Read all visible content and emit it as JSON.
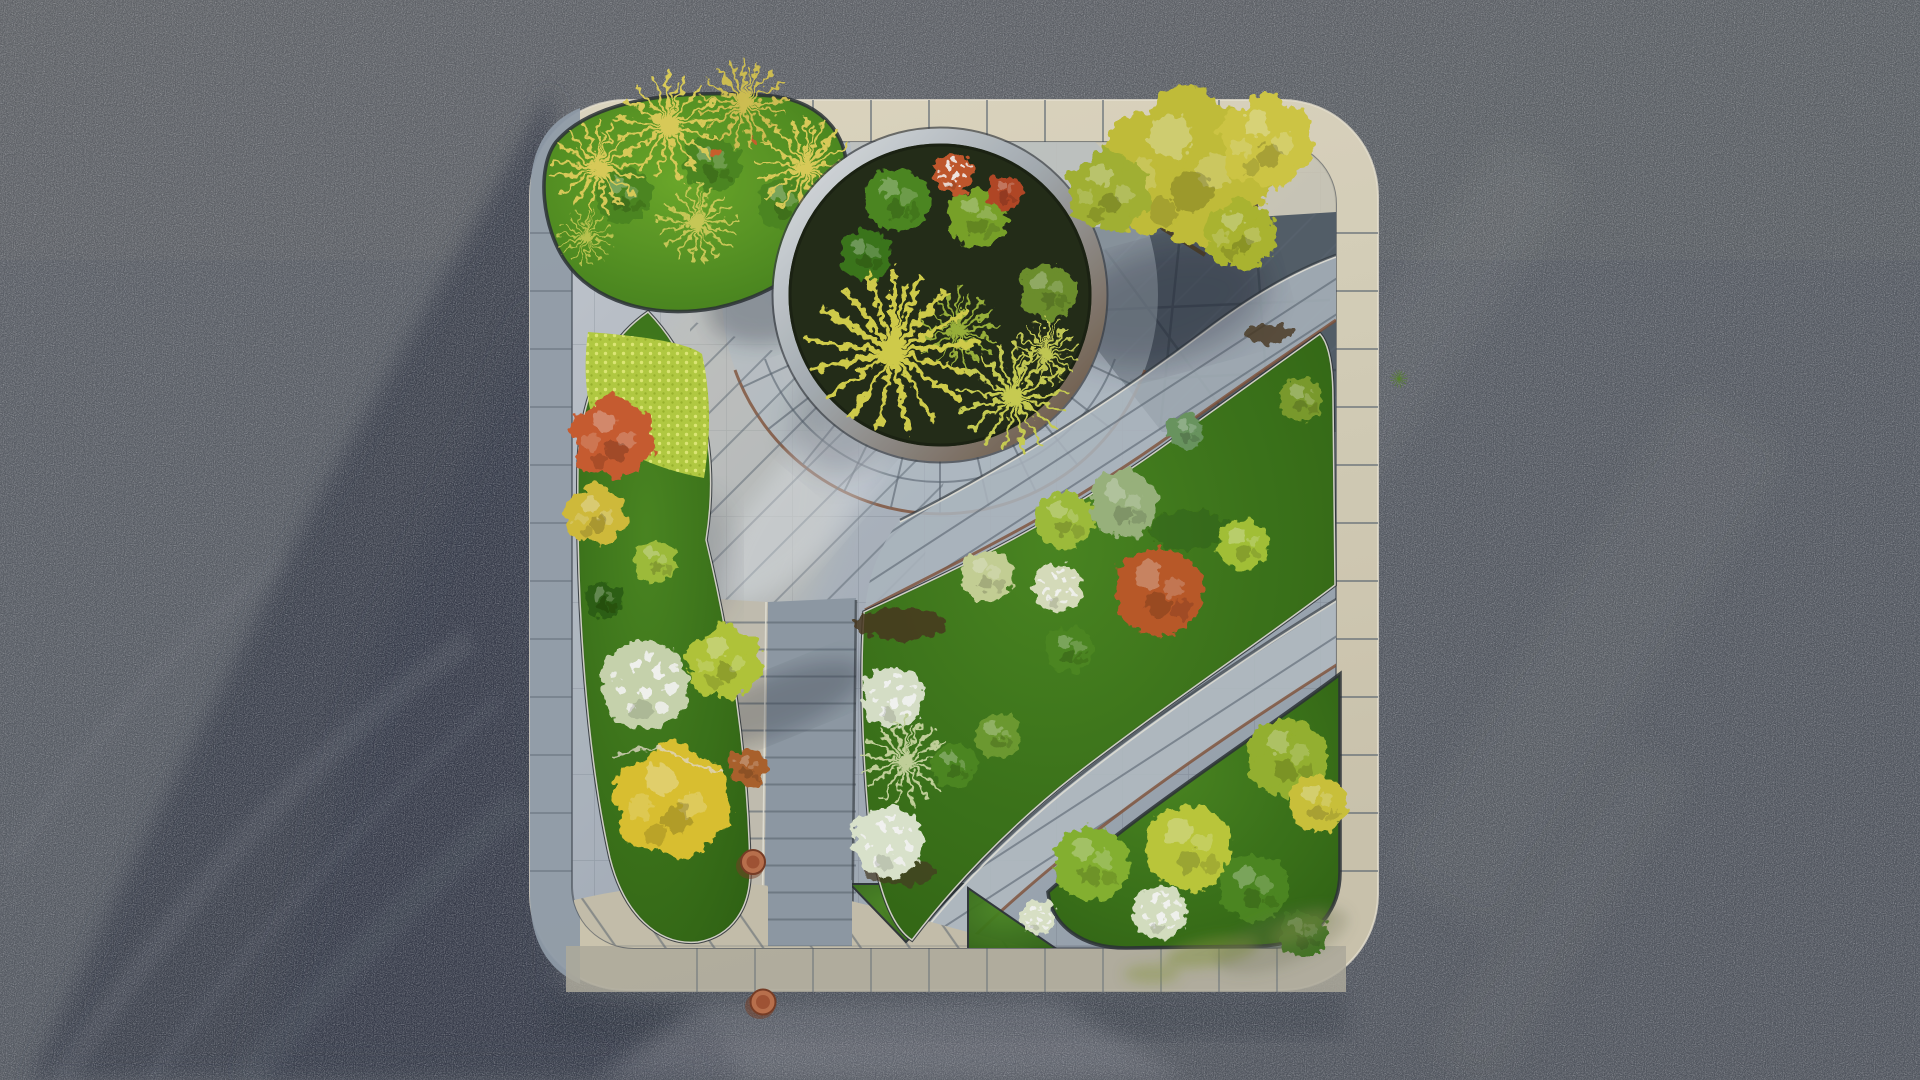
{
  "scene": {
    "title": "Aerial top-down view of a rounded-square landscaped garden plaza set in an asphalt lot, low sun casting a long diagonal shadow from the upper right",
    "setting": "dark speckled asphalt parking surface surrounding a square garden island with rounded corners and a pale stone curb",
    "lighting": "warm low-angle sunlight from the upper right; large soft building shadow covering the left asphalt; streaked tire marks in the shadow",
    "elements": [
      {
        "name": "asphalt-lot",
        "description": "dark blue-grey asphalt with fine stone speckle texture",
        "position": "entire background"
      },
      {
        "name": "building-shadow",
        "description": "long diagonal soft shadow wedge across the asphalt",
        "position": "left half, widening toward bottom-left"
      },
      {
        "name": "plaza",
        "description": "rounded-square garden plaza with pale limestone curb band",
        "position": "center-right of frame"
      },
      {
        "name": "circular-planter",
        "description": "round planter with silver-to-bronze steel rim holding yucca starbursts, ornamental grasses, green and orange shrubs over dark soil",
        "position": "upper middle of plaza"
      },
      {
        "name": "grass-mound",
        "description": "sunlit lawn mound with five golden tussock grasses spilling over the corner curb",
        "position": "top-left corner of plaza"
      },
      {
        "name": "canopy-tree",
        "description": "large yellow-green open-canopy tree shading dark slate paving",
        "position": "top-right of plaza"
      },
      {
        "name": "left-bed",
        "description": "crescent planting bed with chartreuse groundcover, orange-red tree, yellow trees, white flowering tree and a large golden tree at its foot",
        "position": "left side of plaza"
      },
      {
        "name": "central-bed",
        "description": "leaf-shaped lawn bed holding round shrubs: silver-sage, lime, pale yellow, white hydrangeas, large orange-red shrub, blue conifer and a silver spiky yucca, with dark mulch patches",
        "position": "center-right of plaza"
      },
      {
        "name": "corner-bed",
        "description": "lawn bed with lime, golden and white flowering shrubs and moss-stained curb",
        "position": "bottom-right corner of plaza"
      },
      {
        "name": "main-path",
        "description": "two-tone bluestone path with ladder joints, cream column on left and blue-grey column on right, running to the bottom edge",
        "position": "center, vertical"
      },
      {
        "name": "diagonal-path-upper",
        "description": "broad curved paved band with rung joints sweeping from the circle down-right to the east curb",
        "position": "upper right"
      },
      {
        "name": "diagonal-path-lower",
        "description": "second curved paved band with rung joints and rust edging",
        "position": "lower right"
      },
      {
        "name": "paving-ring",
        "description": "radial slab ring with spoke joints encircling the round planter",
        "position": "around circular planter"
      },
      {
        "name": "paving-apron",
        "description": "cream paving apron with diagonal triangular joints and two green lawn wedges",
        "position": "bottom edge of plaza"
      },
      {
        "name": "terracotta-pots",
        "description": "two small terracotta pots beside the main path",
        "position": "bottom center"
      },
      {
        "name": "weed-tuft",
        "description": "tiny green weed growing in the asphalt near the east curb",
        "position": "right of plaza"
      }
    ]
  },
  "palette": {
    "asphalt": "#5c6169",
    "asphalt-shadow": "#3a414e",
    "asphalt-light": "#767a81",
    "border-cream": "#ddd6bf",
    "border-shadow": "#96a2af",
    "border-bottom": "#b5b1a2",
    "paving-light": "#c6ccd4",
    "paving-mid": "#9aa5b1",
    "paving-dark": "#78848f",
    "slate-dark": "#56616c",
    "joint": "#5e6974",
    "curb-rust": "#84543a",
    "edging-dark": "#2d3338",
    "edging-light": "#eceadf",
    "lawn": "#3e7a1d",
    "lawn-dark": "#2f6414",
    "chartreuse": "#b9d244",
    "grass-gold": "#e2d35c",
    "foliage-green": "#4f8c22",
    "foliage-lime": "#a4c33c",
    "foliage-yellow": "#d8c23e",
    "foliage-gold": "#e3c832",
    "foliage-orange": "#cf5f33",
    "foliage-red": "#c05c2c",
    "foliage-white": "#dfe8cf",
    "foliage-silver": "#9fb981",
    "silver-spike": "#c9d8a0",
    "pale-lime": "#ccd79a",
    "conifer": "#6d9a63",
    "sage-white": "#cfdcb4",
    "twig": "#b0652f",
    "soil": "#242e19",
    "mulch": "#4a3a22",
    "rim-silver": "#e8ecef",
    "rim-bronze": "#6a5038",
    "terracotta": "#c07450",
    "moss": "#8a9a40",
    "sheen": "#e9edf2"
  }
}
